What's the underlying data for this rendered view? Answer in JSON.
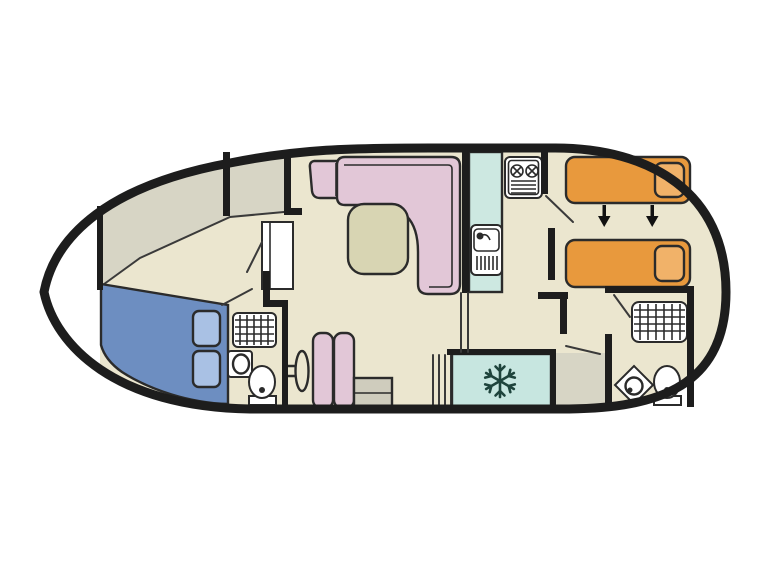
{
  "diagram": {
    "type": "boat-floor-plan",
    "view": "top-down",
    "bow_side": "left",
    "stern_side": "right"
  },
  "colors": {
    "page_bg": "#ffffff",
    "hull_outline": "#1d1d1d",
    "wall": "#1d1d1d",
    "floor": "#ebe6cf",
    "deck": "#d7d5c5",
    "exterior": "#ffffff",
    "double_bed": "#6d8ec1",
    "double_bed_pillow": "#a9c1e4",
    "single_bed": "#e8993d",
    "single_bed_pillow": "#f1b269",
    "seating": "#e2c7d7",
    "table": "#d8d5b3",
    "cabinet": "#cfccbd",
    "counter": "#cde8e1",
    "fridge": "#c7e6e0",
    "fixture": "#ffffff",
    "snowflake": "#1e443c",
    "arrow": "#111111"
  },
  "icons": {
    "snowflake_icon": "fridge-freezer",
    "down_arrows_icon": "beds-convert-to-double",
    "grid_icon": "shower-tray",
    "burners_icon": "two-ring-hob"
  },
  "rooms": [
    {
      "id": "bow-cabin",
      "furniture": [
        "double-bed",
        "wardrobe"
      ]
    },
    {
      "id": "bow-bathroom",
      "furniture": [
        "shower",
        "washbasin",
        "toilet"
      ]
    },
    {
      "id": "saloon",
      "furniture": [
        "corner-seat",
        "l-shaped-sofa",
        "table",
        "steering-wheel",
        "bench-seat",
        "cabinet"
      ]
    },
    {
      "id": "galley",
      "furniture": [
        "counter",
        "sink",
        "hob",
        "steps",
        "fridge-freezer"
      ]
    },
    {
      "id": "stern-cabin",
      "furniture": [
        "single-bed",
        "single-bed"
      ]
    },
    {
      "id": "stern-bathroom",
      "furniture": [
        "shower",
        "corner-washbasin",
        "toilet"
      ]
    }
  ]
}
